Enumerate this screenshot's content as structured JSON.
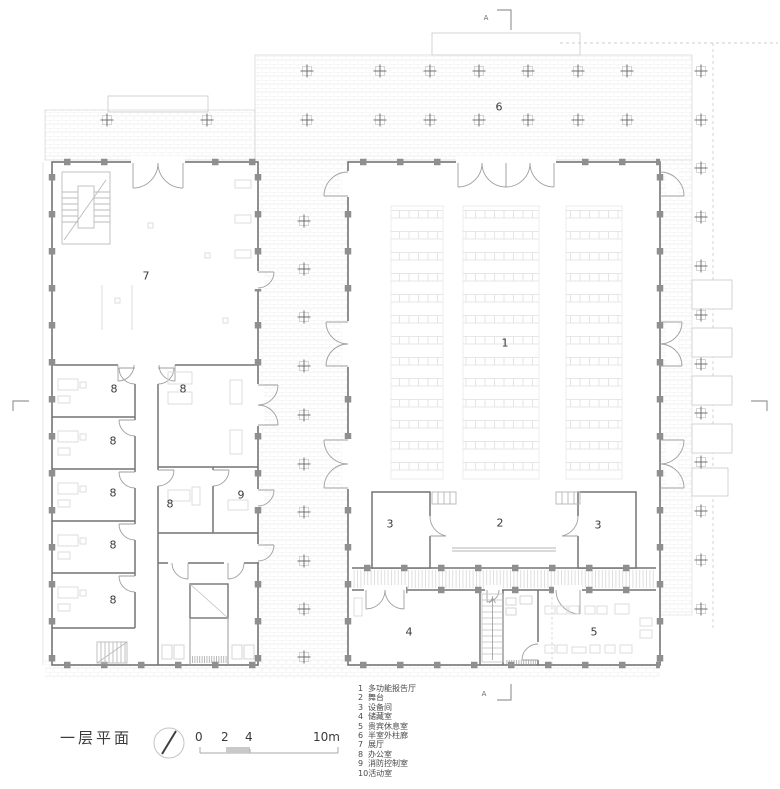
{
  "title": {
    "text": "一层平面"
  },
  "section_marker": {
    "letter": "A"
  },
  "icons": {
    "north_arrow": "compass-needle-icon",
    "column_cross": "column-grid-cross",
    "section_bracket": "section-cut-bracket"
  },
  "colors": {
    "wall": "#747474",
    "light_line": "#c9c9c9",
    "furniture": "#d9d9d9",
    "text": "#3a3a3a"
  },
  "scale_bar": {
    "labels": [
      "0",
      "2",
      "4",
      "10m"
    ]
  },
  "room_labels": {
    "hall": "1",
    "stage": "2",
    "equipment": "3",
    "storage": "4",
    "vip": "5",
    "colonnade": "6",
    "exhibition": "7",
    "office": "8",
    "fire_control": "9"
  },
  "legend": {
    "items": [
      {
        "num": "1",
        "label": "多功能报告厅"
      },
      {
        "num": "2",
        "label": "舞台"
      },
      {
        "num": "3",
        "label": "设备间"
      },
      {
        "num": "4",
        "label": "储藏室"
      },
      {
        "num": "5",
        "label": "贵宾休息室"
      },
      {
        "num": "6",
        "label": "半室外柱廊"
      },
      {
        "num": "7",
        "label": "展厅"
      },
      {
        "num": "8",
        "label": "办公室"
      },
      {
        "num": "9",
        "label": "消防控制室"
      },
      {
        "num": "10",
        "label": "活动室"
      }
    ]
  }
}
